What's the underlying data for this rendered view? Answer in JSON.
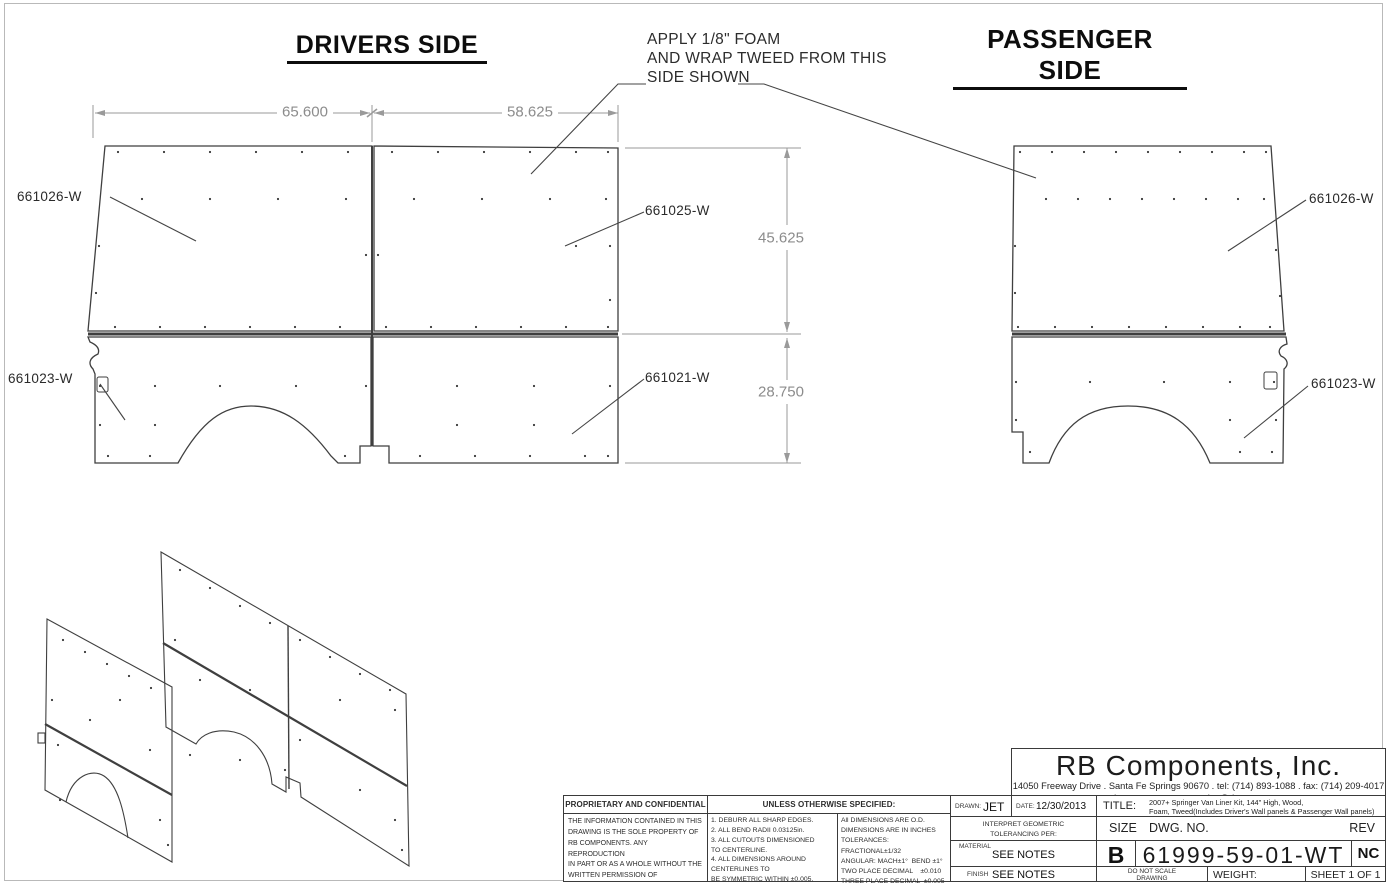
{
  "sheet": {
    "views": {
      "drivers_title": "DRIVERS SIDE",
      "passenger_title": "PASSENGER SIDE"
    },
    "annotation": {
      "line1": "APPLY 1/8\" FOAM",
      "line2": "AND WRAP TWEED FROM THIS",
      "line3": "SIDE SHOWN"
    },
    "dimensions": {
      "top_left_width": "65.600",
      "top_right_width": "58.625",
      "upper_height": "45.625",
      "lower_height": "28.750"
    },
    "part_labels": {
      "drivers_upper_left": "661026-W",
      "drivers_upper_right": "661025-W",
      "drivers_lower_left": "661023-W",
      "drivers_lower_right": "661021-W",
      "passenger_upper": "661026-W",
      "passenger_lower": "661023-W"
    }
  },
  "notes_block": {
    "proprietary_header": "PROPRIETARY AND CONFIDENTIAL",
    "proprietary_body": "THE INFORMATION CONTAINED IN THIS\nDRAWING IS THE SOLE PROPERTY OF\nRB COMPONENTS.  ANY REPRODUCTION\nIN PART OR AS A WHOLE WITHOUT THE\nWRITTEN PERMISSION OF\nRB COMPONENTS IS PROHIBITED.",
    "unless_header": "UNLESS OTHERWISE SPECIFIED:",
    "notes": [
      "1.  DEBURR ALL SHARP EDGES.",
      "2.  ALL BEND RADII 0.03125in.",
      "3.  ALL CUTOUTS DIMENSIONED\n      TO CENTERLINE.",
      "4.  ALL DIMENSIONS AROUND\n      CENTERLINES TO\n      BE SYMMETRIC WITHIN ±0.005.",
      "5.  ALL NON 90° BENDS\n      DIMENSIONED TO VIRTUAL SHARP."
    ],
    "tolerances": "All DIMENSIONS ARE O.D.\nDIMENSIONS ARE IN INCHES\nTOLERANCES:\nFRACTIONAL±1/32\nANGULAR: MACH±1°  BEND ±1°\nTWO PLACE DECIMAL    ±0.010\nTHREE PLACE DECIMAL  ±0.005"
  },
  "title_block": {
    "company": "RB Components, Inc.",
    "address_line1": "14050 Freeway Drive . Santa Fe Springs 90670 . tel: (714) 893-1088 . fax: (714) 209-4017",
    "address_line2": "www.rbcomponents.com . sales@rbcomponents.com",
    "drawn_label": "DRAWN:",
    "drawn_value": "JET",
    "date_label": "DATE:",
    "date_value": "12/30/2013",
    "title_label": "TITLE:",
    "title_line1": "2007+ Springer Van Liner Kit, 144\" High, Wood,",
    "title_line2": "Foam, Tweed(Includes Driver's Wall panels & Passenger Wall panels)",
    "interpret": "INTERPRET GEOMETRIC\nTOLERANCING PER:",
    "material_label": "MATERIAL",
    "material_value": "SEE NOTES",
    "finish_label": "FINISH",
    "finish_value": "SEE NOTES",
    "size_label": "SIZE",
    "dwg_label": "DWG.  NO.",
    "rev_label": "REV",
    "size_value": "B",
    "dwg_value": "61999-59-01-WT",
    "rev_value": "NC",
    "do_not_scale": "DO NOT SCALE\nDRAWING",
    "weight_label": "WEIGHT:",
    "sheet_label": "SHEET 1 OF 1"
  }
}
